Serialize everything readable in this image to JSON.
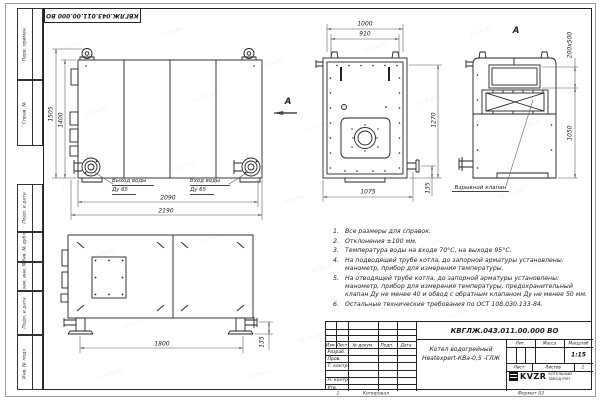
{
  "watermark": {
    "text": "KVZR.RU",
    "positions": [
      [
        60,
        45
      ],
      [
        160,
        30
      ],
      [
        260,
        62
      ],
      [
        365,
        45
      ],
      [
        470,
        30
      ],
      [
        555,
        62
      ],
      [
        85,
        110
      ],
      [
        195,
        95
      ],
      [
        305,
        125
      ],
      [
        415,
        100
      ],
      [
        520,
        122
      ],
      [
        62,
        182
      ],
      [
        172,
        165
      ],
      [
        282,
        198
      ],
      [
        392,
        170
      ],
      [
        500,
        192
      ],
      [
        92,
        252
      ],
      [
        202,
        236
      ],
      [
        312,
        266
      ],
      [
        420,
        242
      ],
      [
        528,
        262
      ],
      [
        122,
        322
      ],
      [
        232,
        306
      ],
      [
        300,
        336
      ],
      [
        450,
        312
      ],
      [
        100,
        372
      ],
      [
        250,
        372
      ]
    ]
  },
  "frame": {
    "stamp_doc_number": "КВГЛЖ.043.011.00.000 ВО",
    "columns": {
      "perv": "Перв. примен.",
      "sprav": "Справ. №",
      "podp1": "Подп. и дата",
      "inv_dubl": "Инв. № дубл.",
      "vzam": "Взам. инв. №",
      "podp2": "Подп. и дата",
      "inv_podl": "Инв. № подл."
    },
    "footer": {
      "num": "1",
      "copied": "Копировал",
      "format": "Формат А3"
    }
  },
  "views": {
    "side": {
      "dim_height_outer": "1505",
      "dim_height_inner": "1400",
      "dim_width_inner": "2090",
      "dim_width_outer": "2190",
      "outlet_label": "Выход воды",
      "outlet_dn": "Ду 65",
      "inlet_label": "Вход воды",
      "inlet_dn": "Ду 65",
      "arrow_label": "А"
    },
    "front": {
      "dim_width_outer": "1000",
      "dim_width_inner": "910",
      "dim_height": "1270",
      "dim_bottom": "1075",
      "dim_pipe_offset": "135"
    },
    "view_a": {
      "label": "А",
      "dim_opening": "200х500",
      "dim_height": "1050",
      "callout": "Взрывной клапан"
    },
    "bottom": {
      "dim_length": "1800",
      "dim_pipe_offset": "135"
    }
  },
  "notes": {
    "items": [
      {
        "num": "1.",
        "text": "Все размеры для справок."
      },
      {
        "num": "2.",
        "text": "Отклонения ±100 мм."
      },
      {
        "num": "3.",
        "text": "Температура воды на входе 70°С, на выходе 95°С."
      },
      {
        "num": "4.",
        "text": "На подводящей трубе котла, до запорной арматуры установлены: манометр, прибор для измерения температуры."
      },
      {
        "num": "5.",
        "text": "На отводящей трубе котла, до запорной арматуры установлены: манометр, прибор для измерения температуры, предохранительный клапан Ду не менее 40 и обвод с обратным клапаном Ду не менее 50 мм."
      },
      {
        "num": "6.",
        "text": "Остальные технические требования по ОСТ 108.030.133-84."
      }
    ]
  },
  "title_block": {
    "doc_number": "КВГЛЖ.043.011.00.000 ВО",
    "name_line1": "Котел водогрейный",
    "name_line2": "Heatexpert-КВа-0,5 -ГЛЖ",
    "header": {
      "izm": "Изм.",
      "list": "Лист",
      "docnum": "№ докум.",
      "podp": "Подп.",
      "data": "Дата"
    },
    "rows": [
      "Разраб.",
      "Пров.",
      "Т. контр.",
      "",
      "Н. контр.",
      "Утв."
    ],
    "lit_label": "Лит.",
    "mass_label": "Масса",
    "scale_label": "Масштаб",
    "scale_value": "1:15",
    "sheet_label": "Лист",
    "sheets_label": "Листов",
    "sheets_value": "1",
    "logo_text": "KVZR",
    "logo_caption": "КОТЕЛЬНЫЙ ЗАВОД РЭП"
  }
}
